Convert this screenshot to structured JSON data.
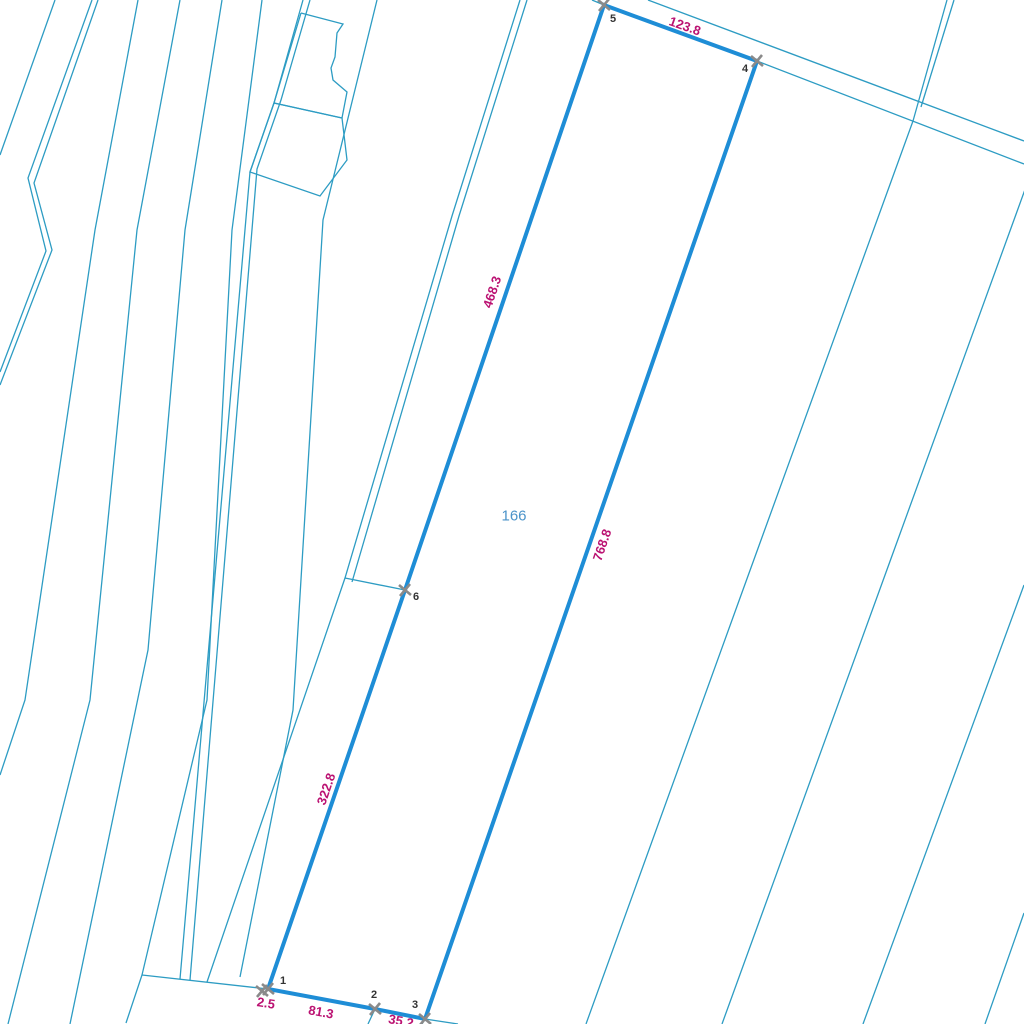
{
  "map": {
    "background_color": "#ffffff",
    "colors": {
      "thin_line": "#2d9cc3",
      "thick_line": "#1e8dd6",
      "length_label": "#bb1272",
      "vertex_label": "#333333",
      "parcel_number": "#4b93c9",
      "vertex_marker": "#8a8a8a"
    },
    "parcel": {
      "number": "166",
      "number_pos": {
        "x": 514,
        "y": 516
      },
      "vertices": [
        {
          "n": "1",
          "x": 268,
          "y": 989,
          "label_x": 280,
          "label_y": 984
        },
        {
          "n": "2",
          "x": 375,
          "y": 1009,
          "label_x": 371,
          "label_y": 998
        },
        {
          "n": "3",
          "x": 425,
          "y": 1019,
          "label_x": 412,
          "label_y": 1008
        },
        {
          "n": "4",
          "x": 757,
          "y": 61,
          "label_x": 742,
          "label_y": 72
        },
        {
          "n": "5",
          "x": 604,
          "y": 5,
          "label_x": 610,
          "label_y": 22
        },
        {
          "n": "6",
          "x": 405,
          "y": 590,
          "label_x": 413,
          "label_y": 600
        }
      ],
      "extra_markers": [
        {
          "x": 262,
          "y": 991
        }
      ],
      "boundary": [
        [
          604,
          5
        ],
        [
          757,
          61
        ],
        [
          425,
          1019
        ],
        [
          375,
          1009
        ],
        [
          268,
          989
        ],
        [
          405,
          590
        ]
      ],
      "edge_labels": [
        {
          "text": "123.8",
          "x": 685,
          "y": 26,
          "rotation": 19.5
        },
        {
          "text": "768.8",
          "x": 602,
          "y": 545,
          "rotation": -71
        },
        {
          "text": "468.3",
          "x": 492,
          "y": 292,
          "rotation": -71.5
        },
        {
          "text": "322.8",
          "x": 326,
          "y": 789,
          "rotation": -71
        },
        {
          "text": "81.3",
          "x": 321,
          "y": 1012,
          "rotation": 10.5
        },
        {
          "text": "35.2",
          "x": 401,
          "y": 1021,
          "rotation": 11
        },
        {
          "text": "2.5",
          "x": 266,
          "y": 1003,
          "rotation": 9
        }
      ]
    },
    "background_lines": [
      {
        "id": "strip-line-1",
        "points": [
          [
            55,
            0
          ],
          [
            0,
            155
          ]
        ]
      },
      {
        "id": "strip-line-2a",
        "points": [
          [
            92,
            0
          ],
          [
            28,
            178
          ],
          [
            46,
            251
          ],
          [
            0,
            372
          ]
        ]
      },
      {
        "id": "strip-line-2b",
        "points": [
          [
            98,
            0
          ],
          [
            34,
            183
          ],
          [
            52,
            250
          ],
          [
            0,
            385
          ]
        ]
      },
      {
        "id": "strip-line-3",
        "points": [
          [
            138,
            0
          ],
          [
            95,
            230
          ],
          [
            25,
            700
          ],
          [
            0,
            775
          ]
        ]
      },
      {
        "id": "strip-line-4",
        "points": [
          [
            180,
            0
          ],
          [
            137,
            230
          ],
          [
            90,
            700
          ],
          [
            8,
            1024
          ]
        ]
      },
      {
        "id": "strip-line-5",
        "points": [
          [
            222,
            0
          ],
          [
            185,
            230
          ],
          [
            148,
            650
          ],
          [
            70,
            1024
          ]
        ]
      },
      {
        "id": "strip-line-6",
        "points": [
          [
            262,
            0
          ],
          [
            232,
            230
          ],
          [
            207,
            700
          ],
          [
            142,
            975
          ],
          [
            126,
            1023
          ]
        ]
      },
      {
        "id": "strip-line-7a",
        "points": [
          [
            303,
            0
          ],
          [
            274,
            103
          ],
          [
            250,
            172
          ],
          [
            180,
            979
          ]
        ]
      },
      {
        "id": "strip-line-7b",
        "points": [
          [
            310,
            0
          ],
          [
            281,
            100
          ],
          [
            257,
            169
          ],
          [
            190,
            980
          ]
        ]
      },
      {
        "id": "strip-line-8",
        "points": [
          [
            377,
            0
          ],
          [
            323,
            220
          ],
          [
            293,
            710
          ],
          [
            240,
            977
          ]
        ]
      },
      {
        "id": "strip-line-9a",
        "points": [
          [
            520,
            0
          ],
          [
            452,
            216
          ],
          [
            345,
            578
          ],
          [
            207,
            982
          ]
        ]
      },
      {
        "id": "strip-line-9b",
        "points": [
          [
            527,
            0
          ],
          [
            459,
            216
          ],
          [
            352,
            582
          ]
        ]
      },
      {
        "id": "spur-to-vertex-6",
        "points": [
          [
            345,
            578
          ],
          [
            405,
            590
          ]
        ]
      },
      {
        "id": "bottom-boundary-line",
        "points": [
          [
            142,
            975
          ],
          [
            268,
            989
          ],
          [
            375,
            1009
          ],
          [
            425,
            1019
          ],
          [
            458,
            1024
          ]
        ]
      },
      {
        "id": "vertex-2-stub",
        "points": [
          [
            375,
            1009
          ],
          [
            368,
            1024
          ]
        ]
      },
      {
        "id": "vertex-3-stub",
        "points": [
          [
            425,
            1019
          ],
          [
            422,
            1024
          ]
        ]
      },
      {
        "id": "road-upper-edge",
        "points": [
          [
            648,
            0
          ],
          [
            1024,
            141
          ]
        ]
      },
      {
        "id": "road-lower-edge",
        "points": [
          [
            592,
            0
          ],
          [
            604,
            5
          ],
          [
            757,
            61
          ],
          [
            1024,
            164
          ]
        ]
      },
      {
        "id": "crossing-pair-a",
        "points": [
          [
            947,
            0
          ],
          [
            913,
            121
          ]
        ]
      },
      {
        "id": "crossing-pair-b",
        "points": [
          [
            954,
            0
          ],
          [
            921,
            107
          ]
        ]
      },
      {
        "id": "strip-line-10",
        "points": [
          [
            913,
            121
          ],
          [
            740,
            598
          ],
          [
            586,
            1024
          ]
        ]
      },
      {
        "id": "strip-line-11",
        "points": [
          [
            1031,
            173
          ],
          [
            722,
            1024
          ]
        ]
      },
      {
        "id": "strip-line-12",
        "points": [
          [
            1024,
            585
          ],
          [
            863,
            1024
          ]
        ]
      },
      {
        "id": "strip-line-13",
        "points": [
          [
            1024,
            913
          ],
          [
            985,
            1024
          ]
        ]
      },
      {
        "id": "small-parcel-upper",
        "points": [
          [
            301,
            13
          ],
          [
            343,
            24
          ],
          [
            337,
            33
          ],
          [
            335,
            57
          ],
          [
            331,
            68
          ],
          [
            333,
            80
          ],
          [
            347,
            92
          ],
          [
            342,
            118
          ],
          [
            274,
            103
          ],
          [
            301,
            13
          ]
        ]
      },
      {
        "id": "small-parcel-lower",
        "points": [
          [
            274,
            103
          ],
          [
            342,
            118
          ],
          [
            347,
            160
          ],
          [
            320,
            196
          ],
          [
            250,
            172
          ],
          [
            274,
            103
          ]
        ]
      }
    ],
    "style": {
      "thin_width": 1.3,
      "thick_width": 4,
      "marker_arm": 6,
      "marker_width": 2.6,
      "vertex_font_size": 11,
      "length_font_size": 13,
      "parcel_number_font_size": 15
    }
  }
}
